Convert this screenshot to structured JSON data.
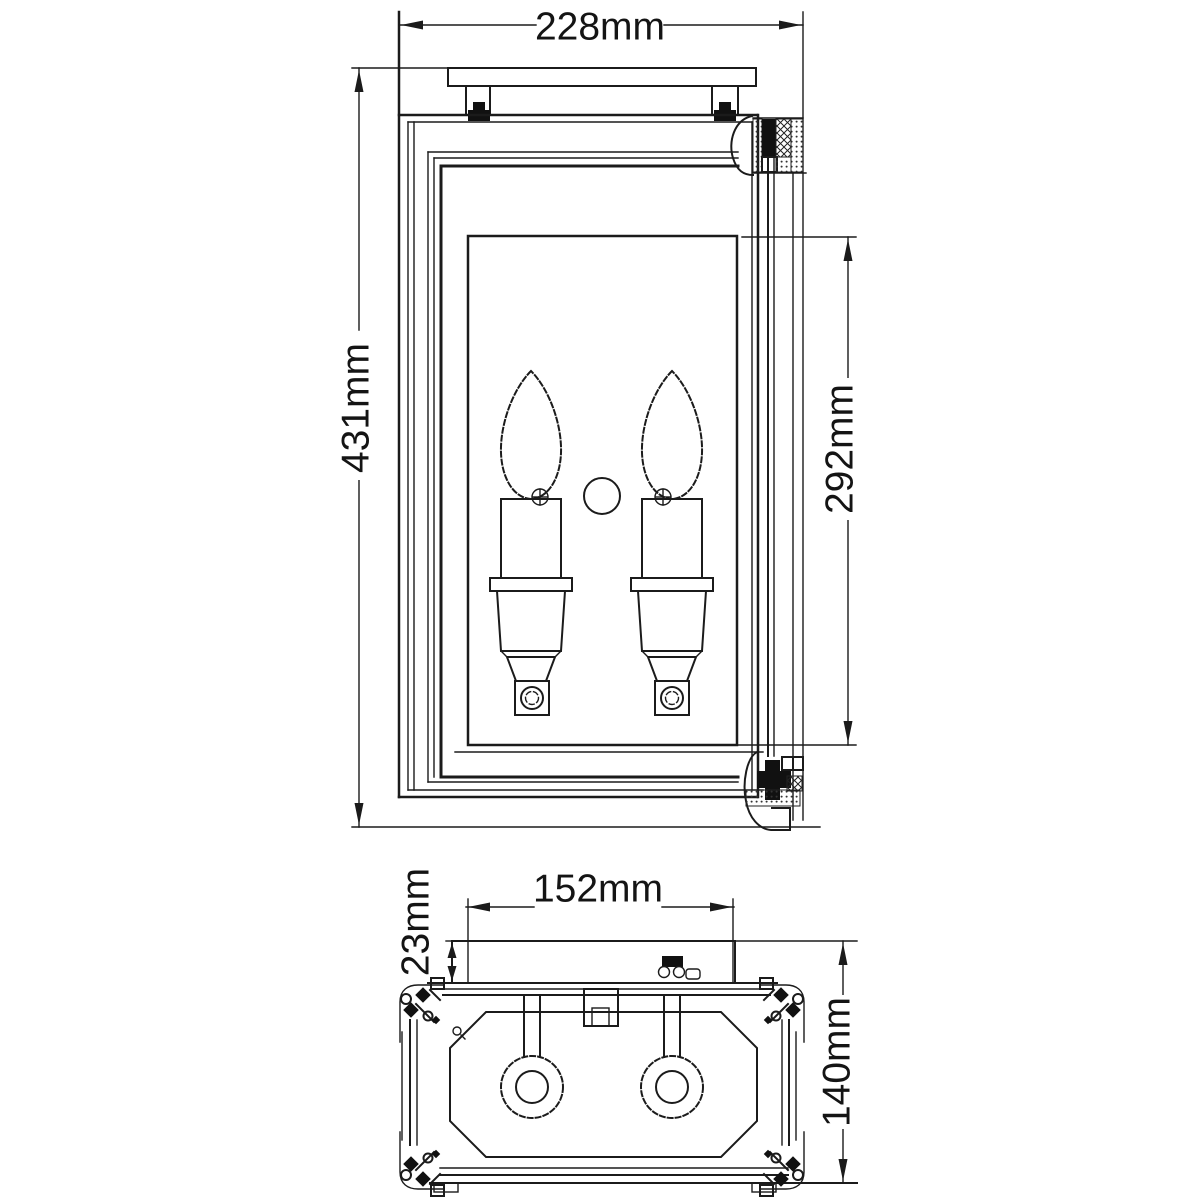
{
  "drawing": {
    "kind": "technical dimension drawing, two-candle wall lantern",
    "background": "#ffffff",
    "line_color": "#1b1b1b",
    "views": [
      {
        "name": "front-elevation",
        "dimensions": [
          {
            "id": "overall-width",
            "label": "228mm",
            "orientation": "horizontal"
          },
          {
            "id": "overall-height",
            "label": "431mm",
            "orientation": "vertical"
          },
          {
            "id": "glass-height",
            "label": "292mm",
            "orientation": "vertical"
          }
        ]
      },
      {
        "name": "top-plan",
        "dimensions": [
          {
            "id": "backplate-width",
            "label": "152mm",
            "orientation": "horizontal"
          },
          {
            "id": "backplate-depth",
            "label": "23mm",
            "orientation": "vertical"
          },
          {
            "id": "overall-depth",
            "label": "140mm",
            "orientation": "vertical"
          }
        ]
      }
    ]
  }
}
